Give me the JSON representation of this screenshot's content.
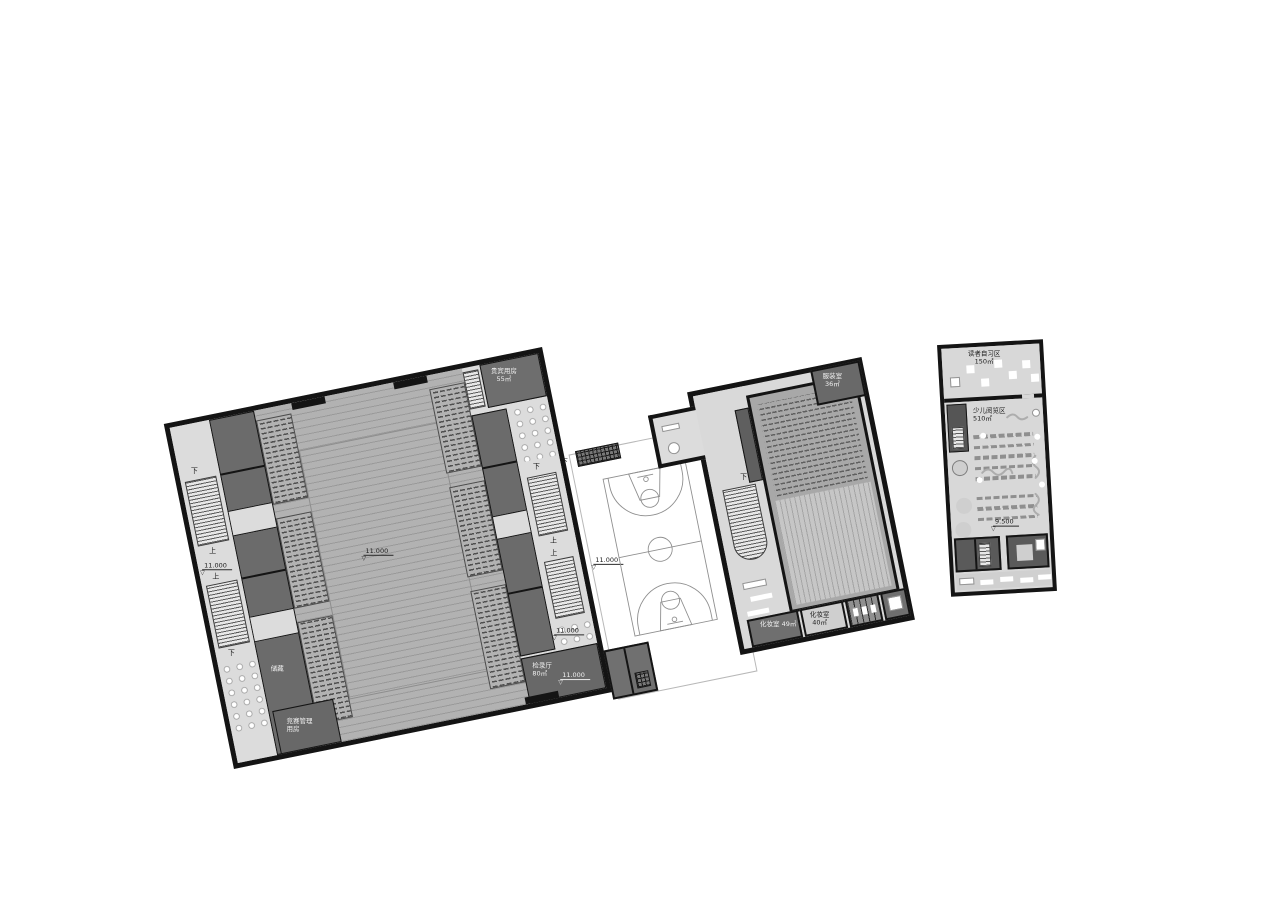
{
  "stairs": {
    "up": "上",
    "down": "下"
  },
  "levels": {
    "gym": "11.000",
    "court": "11.000",
    "theater": "9.500",
    "library": "9.500"
  },
  "gym": {
    "vip_name": "贵宾用房",
    "vip_area": "55㎡",
    "mgmt_name": "竞赛管理",
    "mgmt_name2": "用房",
    "storage_name": "储藏",
    "checkin_name": "检录厅",
    "checkin_area": "80㎡"
  },
  "theater": {
    "costume_name": "服装室",
    "costume_area": "36㎡",
    "makeup1_name": "化妆室",
    "makeup1_area": "49㎡",
    "makeup2_name": "化妆室",
    "makeup2_area": "40㎡"
  },
  "library": {
    "study_name": "读者自习区",
    "study_area": "150㎡",
    "children_name": "少儿阅览区",
    "children_area": "510㎡"
  },
  "colors": {
    "wall": "#141414",
    "room_dark": "#6b6b6b",
    "corridor": "#dcdcdc",
    "arena": "#b2b2b2",
    "paper": "#ffffff"
  }
}
